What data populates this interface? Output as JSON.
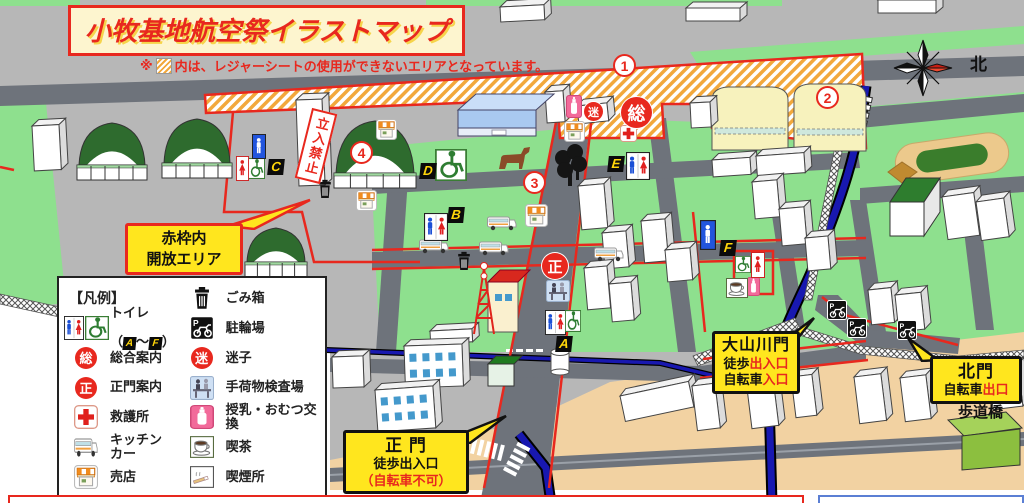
{
  "title": "小牧基地航空祭イラストマップ",
  "note": {
    "mark": "※",
    "text": "内は、レジャーシートの使用ができないエリアとなっています。"
  },
  "compass": {
    "north": "北"
  },
  "signs": {
    "no_entry": "立入禁止",
    "footbridge": "歩道橋",
    "open_area": {
      "line1": "赤枠内",
      "line2": "開放エリア"
    }
  },
  "gates": {
    "main": {
      "name": "正 門",
      "line2": "徒歩出入口",
      "line3": "（自転車不可）"
    },
    "oyamakawa": {
      "name": "大山川門",
      "line2_black": "徒歩",
      "line2_red": "出入口",
      "line3_black": "自転車",
      "line3_red": "入口"
    },
    "north": {
      "name": "北門",
      "line2_black": "自転車",
      "line2_red": "出口"
    }
  },
  "legend": {
    "header": "【凡例】",
    "toilet": {
      "label": "トイレ",
      "open": "（",
      "from": "A",
      "tilde": "～",
      "to": "F",
      "close": "）"
    },
    "left_items": [
      {
        "icon": "info",
        "text": "総",
        "label": "総合案内"
      },
      {
        "icon": "info",
        "text": "正",
        "label": "正門案内"
      },
      {
        "icon": "aid",
        "label": "救護所"
      },
      {
        "icon": "kitchen-car",
        "label": "キッチン\nカー"
      },
      {
        "icon": "shop",
        "label": "売店"
      }
    ],
    "right_items": [
      {
        "icon": "trash",
        "label": "ごみ箱"
      },
      {
        "icon": "bike",
        "label": "駐輪場"
      },
      {
        "icon": "info",
        "text": "迷",
        "label": "迷子"
      },
      {
        "icon": "baggage",
        "label": "手荷物検査場"
      },
      {
        "icon": "nursing",
        "label": "授乳・おむつ交換"
      },
      {
        "icon": "cafe",
        "label": "喫茶"
      },
      {
        "icon": "smoking",
        "label": "喫煙所"
      }
    ]
  },
  "colors": {
    "red": "#e8281e",
    "green": "#8ee08e",
    "road": "#6e737b",
    "tan": "#f2d2a2",
    "river": "#1818b0",
    "bubble_yellow": "#ffe61e",
    "hatch_orange": "#f2a83c"
  },
  "markers": {
    "letters": [
      {
        "label": "A",
        "x": 556,
        "y": 336
      },
      {
        "label": "B",
        "x": 448,
        "y": 207
      },
      {
        "label": "C",
        "x": 268,
        "y": 159
      },
      {
        "label": "D",
        "x": 420,
        "y": 163
      },
      {
        "label": "E",
        "x": 608,
        "y": 156
      },
      {
        "label": "F",
        "x": 720,
        "y": 240
      }
    ],
    "numbers": [
      {
        "label": "1",
        "x": 613,
        "y": 54
      },
      {
        "label": "2",
        "x": 816,
        "y": 86
      },
      {
        "label": "3",
        "x": 523,
        "y": 171
      },
      {
        "label": "4",
        "x": 350,
        "y": 141
      }
    ],
    "info_circles": [
      {
        "text": "総",
        "x": 621,
        "y": 97,
        "d": 31
      },
      {
        "text": "迷",
        "x": 584,
        "y": 102,
        "d": 19
      },
      {
        "text": "正",
        "x": 542,
        "y": 253,
        "d": 26
      }
    ],
    "icons": [
      {
        "type": "aid",
        "x": 620,
        "y": 125,
        "w": 17,
        "h": 17
      },
      {
        "type": "nursing",
        "x": 566,
        "y": 95,
        "w": 16,
        "h": 23
      },
      {
        "type": "nursing",
        "x": 747,
        "y": 277,
        "w": 13,
        "h": 19
      },
      {
        "type": "shop",
        "x": 376,
        "y": 119,
        "w": 21,
        "h": 21
      },
      {
        "type": "shop",
        "x": 356,
        "y": 190,
        "w": 21,
        "h": 21
      },
      {
        "type": "shop",
        "x": 564,
        "y": 121,
        "w": 21,
        "h": 21
      },
      {
        "type": "shop",
        "x": 525,
        "y": 204,
        "w": 23,
        "h": 23
      },
      {
        "type": "kitchen-car",
        "x": 487,
        "y": 214,
        "w": 30,
        "h": 18
      },
      {
        "type": "kitchen-car",
        "x": 419,
        "y": 237,
        "w": 30,
        "h": 18
      },
      {
        "type": "kitchen-car",
        "x": 479,
        "y": 239,
        "w": 30,
        "h": 18
      },
      {
        "type": "kitchen-car",
        "x": 594,
        "y": 245,
        "w": 30,
        "h": 18
      },
      {
        "type": "trash",
        "x": 317,
        "y": 179,
        "w": 16,
        "h": 20
      },
      {
        "type": "trash",
        "x": 456,
        "y": 251,
        "w": 16,
        "h": 20
      },
      {
        "type": "bike",
        "x": 827,
        "y": 300,
        "w": 20,
        "h": 20
      },
      {
        "type": "bike",
        "x": 847,
        "y": 318,
        "w": 20,
        "h": 20
      },
      {
        "type": "bike",
        "x": 897,
        "y": 320,
        "w": 20,
        "h": 20
      },
      {
        "type": "cafe",
        "x": 726,
        "y": 278,
        "w": 22,
        "h": 20
      },
      {
        "type": "baggage",
        "x": 546,
        "y": 280,
        "w": 24,
        "h": 22
      },
      {
        "type": "toilet-mf",
        "x": 424,
        "y": 213,
        "w": 24,
        "h": 28
      },
      {
        "type": "toilet-mf",
        "x": 626,
        "y": 152,
        "w": 24,
        "h": 28
      },
      {
        "type": "toilet-mf",
        "x": 545,
        "y": 310,
        "w": 21,
        "h": 25
      },
      {
        "type": "wheelchair",
        "x": 435,
        "y": 149,
        "w": 32,
        "h": 32
      },
      {
        "type": "wheelchair",
        "x": 565,
        "y": 310,
        "w": 16,
        "h": 22
      },
      {
        "type": "wheelchair",
        "x": 735,
        "y": 256,
        "w": 16,
        "h": 17
      },
      {
        "type": "wheelchair",
        "x": 248,
        "y": 158,
        "w": 17,
        "h": 21
      },
      {
        "type": "toilet-m",
        "x": 700,
        "y": 220,
        "w": 16,
        "h": 30
      },
      {
        "type": "toilet-m",
        "x": 252,
        "y": 134,
        "w": 14,
        "h": 25
      },
      {
        "type": "toilet-f",
        "x": 751,
        "y": 252,
        "w": 14,
        "h": 26
      },
      {
        "type": "toilet-f",
        "x": 236,
        "y": 156,
        "w": 13,
        "h": 25
      },
      {
        "type": "dog",
        "x": 495,
        "y": 145,
        "w": 38,
        "h": 26
      },
      {
        "type": "trees",
        "x": 551,
        "y": 144,
        "w": 38,
        "h": 44
      }
    ]
  }
}
